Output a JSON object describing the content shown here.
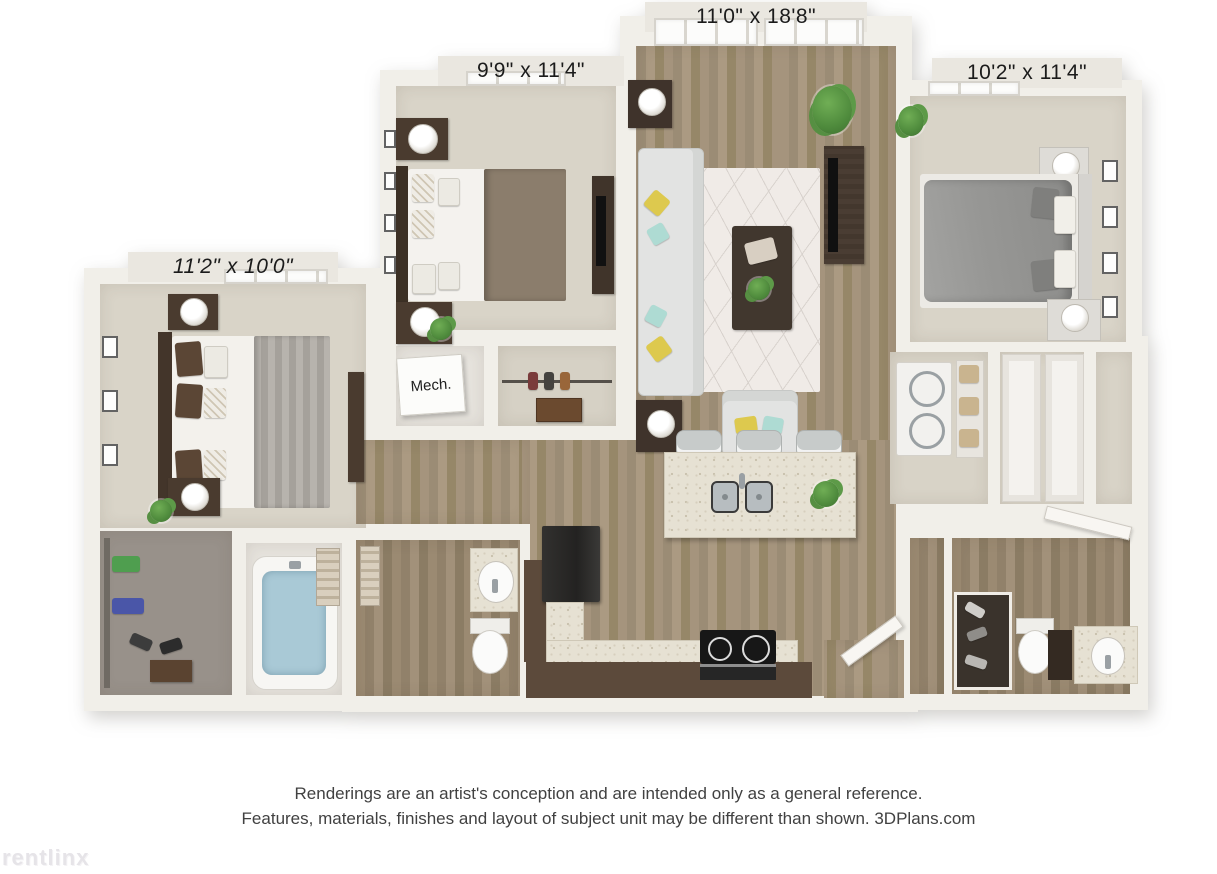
{
  "palette": {
    "wall": "#f1efe9",
    "carpet": "#d9d4c8",
    "wood_floor": "#a0907a",
    "bath_wood_floor": "#96866f",
    "counter_granite": "#e6e1d3",
    "cabinet_brown": "#5c4a3b",
    "appliance_black": "#252423",
    "sofa_gray": "#e2e3e2",
    "accent_yellow": "#ddc94e",
    "accent_teal": "#aedbd3",
    "tub_water_blue": "#a9c9d6",
    "plant_green": "#4e8a3c",
    "label_text": "#1b1b1b",
    "disclaimer_text": "#414141",
    "watermark_gray": "#e6e4e8"
  },
  "floorplan": {
    "labels": {
      "living_room": "11'0\" x 18'8\"",
      "bedroom_top_left": "9'9\" x 11'4\"",
      "bedroom_top_right": "10'2\" x 11'4\"",
      "bedroom_left": "11'2\" x 10'0\"",
      "mech_room": "Mech."
    },
    "rooms": [
      "living-room",
      "bedroom-top-left",
      "bedroom-top-right",
      "bedroom-left",
      "kitchen",
      "hallway",
      "mech-room",
      "hall-closet",
      "walk-in-closet",
      "bathroom-1",
      "bathroom-2",
      "laundry-closet",
      "linen-closet",
      "entry"
    ]
  },
  "disclaimer": {
    "line1": "Renderings are an artist's conception and are intended only as a general reference.",
    "line2": "Features, materials, finishes and layout of subject unit may be different than shown. 3DPlans.com"
  },
  "watermark": {
    "text": "rentlinx"
  }
}
